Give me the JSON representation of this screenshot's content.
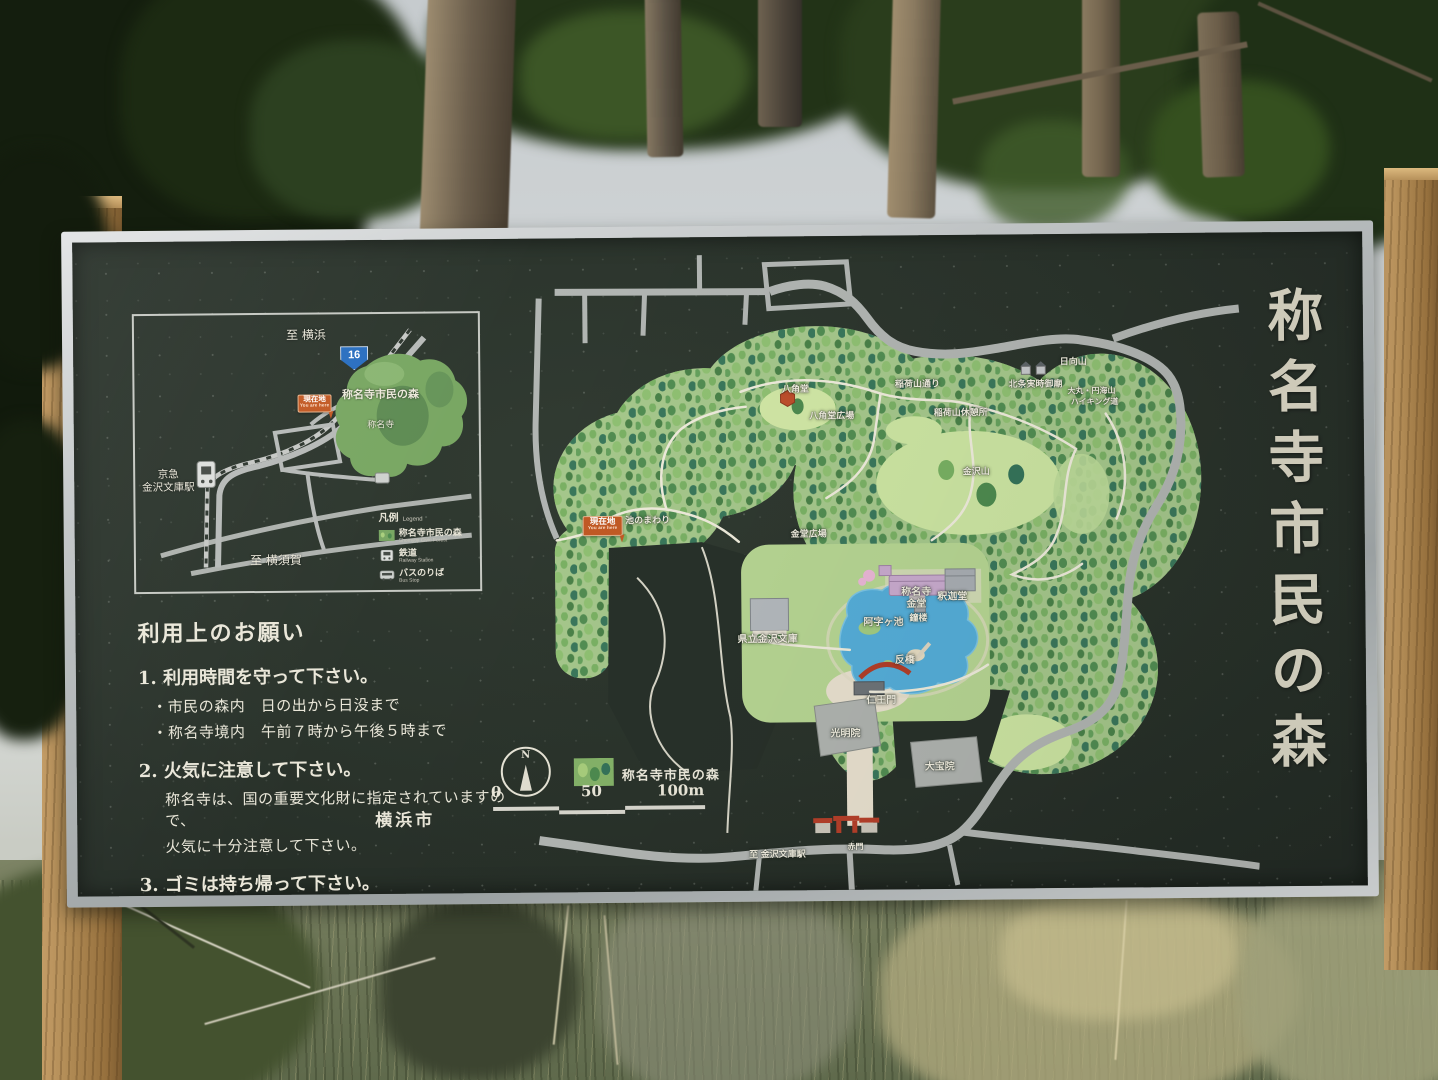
{
  "colors": {
    "board_green": "#2a332b",
    "frame_metal": "#b9bcbd",
    "post_wood": "#b08a54",
    "forest_green": "#a6c88c",
    "pond_blue": "#55aed9",
    "marker_orange": "#c35a25",
    "route_shield_blue": "#2a6fc0",
    "title_text": "#dcd8c6"
  },
  "board": {
    "vertical_title": "称名寺市民の森",
    "city": "横浜市"
  },
  "inset_map": {
    "to_yokohama": "至 横浜",
    "to_yokosuka": "至 横須賀",
    "route_number": "16",
    "station_line1": "京急",
    "station_line2": "金沢文庫駅",
    "forest_label": "称名寺市民の森",
    "temple_label": "称名寺",
    "you_are_here": "現在地",
    "you_are_here_en": "You are here"
  },
  "legend": {
    "title": "凡例",
    "title_en": "Legend",
    "items": [
      {
        "icon": "forest-swatch",
        "label": "称名寺市民の森",
        "label_en": "Shomyoji Civic Forest"
      },
      {
        "icon": "train-icon",
        "label": "鉄道",
        "label_en": "Railway Station"
      },
      {
        "icon": "bus-icon",
        "label": "バスのりば",
        "label_en": "Bus Stop"
      }
    ]
  },
  "usage": {
    "title": "利用上のお願い",
    "rules": [
      {
        "heading": "1. 利用時間を守って下さい。",
        "lines": [
          "・市民の森内　日の出から日没まで",
          "・称名寺境内　午前７時から午後５時まで"
        ]
      },
      {
        "heading": "2. 火気に注意して下さい。",
        "lines": [
          "称名寺は、国の重要文化財に指定されていますので、",
          "火気に十分注意して下さい。"
        ]
      },
      {
        "heading": "3. ゴミは持ち帰って下さい。",
        "lines": []
      }
    ]
  },
  "map_key": {
    "north_label": "N",
    "forest_legend": "称名寺市民の森",
    "scale_ticks": [
      "0",
      "50",
      "100m"
    ]
  },
  "main_map": {
    "you_are_here": "現在地",
    "you_are_here_en": "You are here",
    "labels": [
      {
        "text": "八角堂",
        "x": 280,
        "y": 142,
        "fs": 9
      },
      {
        "text": "八角堂広場",
        "x": 316,
        "y": 169,
        "fs": 9
      },
      {
        "text": "稲荷山通り",
        "x": 402,
        "y": 138,
        "fs": 9
      },
      {
        "text": "稲荷山休憩所",
        "x": 445,
        "y": 167,
        "fs": 9
      },
      {
        "text": "日向山",
        "x": 558,
        "y": 117,
        "fs": 9
      },
      {
        "text": "北条実時御廟",
        "x": 520,
        "y": 139,
        "fs": 9
      },
      {
        "text": "大丸・円海山",
        "x": 576,
        "y": 147,
        "fs": 8
      },
      {
        "text": "ハイキング道",
        "x": 579,
        "y": 158,
        "fs": 8
      },
      {
        "text": "金沢山",
        "x": 460,
        "y": 226,
        "fs": 9
      },
      {
        "text": "金堂広場",
        "x": 292,
        "y": 287,
        "fs": 9
      },
      {
        "text": "池のまわり",
        "x": 131,
        "y": 272,
        "fs": 9
      },
      {
        "text": "県立金沢文庫",
        "x": 250,
        "y": 391,
        "fs": 10
      },
      {
        "text": "阿字ヶ池",
        "x": 366,
        "y": 375,
        "fs": 10
      },
      {
        "text": "称名寺",
        "x": 399,
        "y": 345,
        "fs": 10
      },
      {
        "text": "金堂",
        "x": 399,
        "y": 357,
        "fs": 10
      },
      {
        "text": "釈迦堂",
        "x": 435,
        "y": 350,
        "fs": 10
      },
      {
        "text": "鐘楼",
        "x": 401,
        "y": 372,
        "fs": 9
      },
      {
        "text": "反橋",
        "x": 387,
        "y": 413,
        "fs": 10
      },
      {
        "text": "仁王門",
        "x": 363,
        "y": 453,
        "fs": 10
      },
      {
        "text": "光明院",
        "x": 327,
        "y": 486,
        "fs": 10
      },
      {
        "text": "大宝院",
        "x": 421,
        "y": 520,
        "fs": 10
      },
      {
        "text": "赤門",
        "x": 336,
        "y": 601,
        "fs": 8
      },
      {
        "text": "至 金沢文庫駅",
        "x": 258,
        "y": 607,
        "fs": 9
      }
    ]
  }
}
